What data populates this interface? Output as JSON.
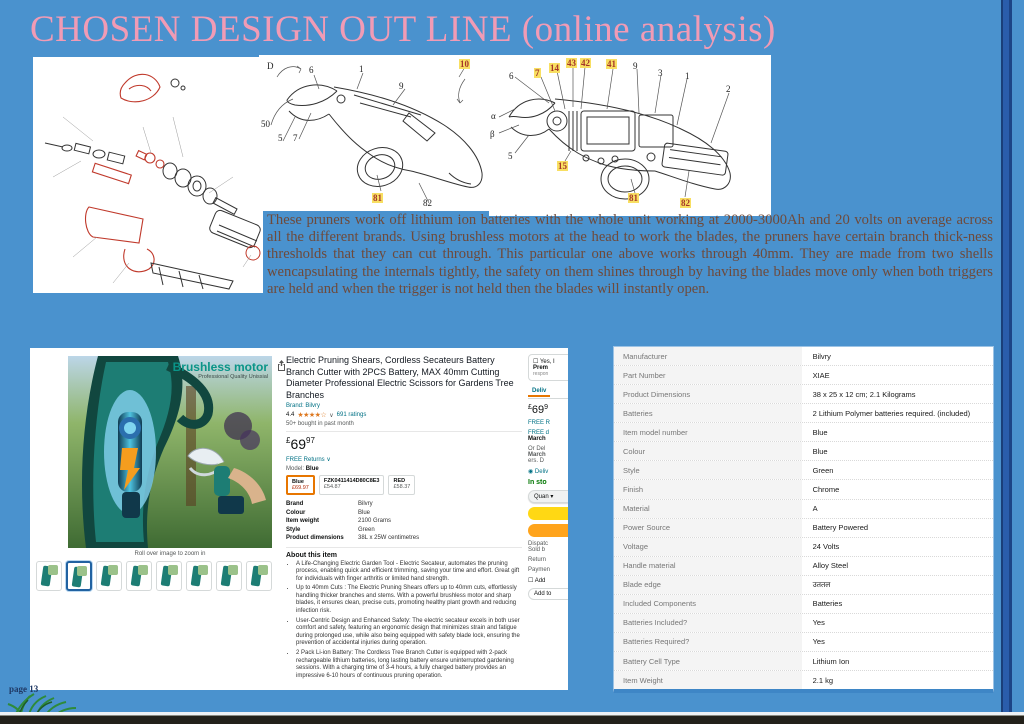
{
  "slide": {
    "title": "CHOSEN DESIGN OUT LINE (online analysis)",
    "page_label": "page 13",
    "paragraph": "These pruners work off lithium ion batteries with the whole unit working at 2000-3000Ah and 20 volts on average across all the different brands. Using brushless motors at the head to work the blades, the pruners have certain branch thick-ness thresholds that they can cut through. This particular one above works through 40mm. They are made from two shells wencapsulating the internals tightly, the safety on them shines through by having the blades move only when both triggers are held and when the trigger is not held then the blades will instantly open."
  },
  "diagrams": {
    "side_labels": [
      {
        "text": "D",
        "x": 8,
        "y": 6
      },
      {
        "text": "6",
        "x": 50,
        "y": 10
      },
      {
        "text": "1",
        "x": 100,
        "y": 9
      },
      {
        "text": "9",
        "x": 140,
        "y": 26
      },
      {
        "text": "10",
        "x": 200,
        "y": 4,
        "hl": true
      },
      {
        "text": "50",
        "x": 2,
        "y": 64,
        "amber": true
      },
      {
        "text": "5",
        "x": 19,
        "y": 78
      },
      {
        "text": "7",
        "x": 34,
        "y": 78
      },
      {
        "text": "81",
        "x": 113,
        "y": 138,
        "hl": true
      },
      {
        "text": "82",
        "x": 164,
        "y": 143
      }
    ],
    "cutaway_labels": [
      {
        "text": "6",
        "x": 20,
        "y": 16
      },
      {
        "text": "7",
        "x": 45,
        "y": 13,
        "hl": true
      },
      {
        "text": "14",
        "x": 60,
        "y": 8,
        "hl": true
      },
      {
        "text": "43",
        "x": 77,
        "y": 3,
        "hl": true
      },
      {
        "text": "42",
        "x": 91,
        "y": 3,
        "hl": true
      },
      {
        "text": "41",
        "x": 117,
        "y": 4,
        "hl": true
      },
      {
        "text": "9",
        "x": 144,
        "y": 6
      },
      {
        "text": "3",
        "x": 169,
        "y": 13
      },
      {
        "text": "1",
        "x": 196,
        "y": 16
      },
      {
        "text": "2",
        "x": 237,
        "y": 29
      },
      {
        "text": "α",
        "x": 2,
        "y": 56
      },
      {
        "text": "β",
        "x": 1,
        "y": 74
      },
      {
        "text": "5",
        "x": 19,
        "y": 96
      },
      {
        "text": "15",
        "x": 68,
        "y": 106,
        "hl": true
      },
      {
        "text": "81",
        "x": 139,
        "y": 138,
        "hl": true
      },
      {
        "text": "82",
        "x": 191,
        "y": 143,
        "hl": true
      }
    ]
  },
  "product_page": {
    "image_overlay_title": "Brushless motor",
    "image_overlay_subtitle": "Professional Quality Unissial",
    "image_caption": "Roll over image to zoom in",
    "thumbnails": [
      {
        "sel": false
      },
      {
        "sel": true
      },
      {
        "sel": false
      },
      {
        "sel": false
      },
      {
        "sel": false
      },
      {
        "sel": false
      },
      {
        "sel": false
      },
      {
        "sel": false
      }
    ],
    "title": "Electric Pruning Shears, Cordless Secateurs Battery Branch Cutter with 2PCS Battery, MAX 40mm Cutting Diameter Professional Electric Scissors for Gardens Tree Branches",
    "brand_line": "Brand: Bilvry",
    "rating_value": "4.4",
    "stars": "★★★★☆",
    "rating_caret": "∨",
    "ratings_count": "691 ratings",
    "bought_note": "50+ bought in past month",
    "price": {
      "symbol": "£",
      "whole": "69",
      "fraction": "97"
    },
    "free_returns": "FREE Returns ∨",
    "model_label": "Model:",
    "model_value": "Blue",
    "variants": [
      {
        "name": "Blue",
        "price": "£69.97",
        "sel": true
      },
      {
        "name": "FZK0411414D80C8E3",
        "price": "£54.87",
        "sel": false
      },
      {
        "name": "RED",
        "price": "£58.37",
        "sel": false
      }
    ],
    "mini_specs": [
      {
        "label": "Brand",
        "value": "Bilvry"
      },
      {
        "label": "Colour",
        "value": "Blue"
      },
      {
        "label": "Item weight",
        "value": "2100 Grams"
      },
      {
        "label": "Style",
        "value": "Green"
      },
      {
        "label": "Product dimensions",
        "value": "38L x 25W centimetres"
      }
    ],
    "about_title": "About this item",
    "about_bullets": [
      "A Life-Changing Electric Garden Tool - Electric Secateur, automates the pruning process, enabling quick and efficient trimming, saving your time and effort. Great gift for individuals with finger arthritis or limited hand strength.",
      "Up to 40mm Cuts : The Electric Pruning Shears offers up to 40mm cuts, effortlessly handling thicker branches and stems. With a powerful brushless motor and sharp blades, it ensures clean, precise cuts, promoting healthy plant growth and reducing infection risk.",
      "User-Centric Design and Enhanced Safety: The electric secateur excels in both user comfort and safety, featuring an ergonomic design that minimizes strain and fatigue during prolonged use, while also being equipped with safety blade lock, ensuring the prevention of accidental injuries during operation.",
      "2 Pack Li-ion Battery: The Cordless Tree Branch Cutter is equipped with 2-pack rechargeable lithium batteries, long lasting battery ensure uninterrupted gardening sessions. With a charging time of 3-4 hours, a fully charged battery provides an impressive 6-10 hours of continuous pruning operation."
    ],
    "buy_column": {
      "prime_check": "☐ Yes, I",
      "prime_bold": "Prem",
      "prime_small": "respon",
      "tab": "Deliv",
      "price_whole": "69",
      "price_symbol": "£",
      "price_fraction": "9",
      "free_returns": "FREE R",
      "free_delivery": "FREE d",
      "date1": "March",
      "or_fast": "Or Del",
      "date2": "March",
      "date2_tail": "ers. D",
      "deliver_to": "◉ Deliv",
      "stock": "In sto",
      "quantity": "Quan ▾",
      "dispatch": "Dispatc",
      "sold_by": "Sold b",
      "returns": "Return",
      "payment": "Paymen",
      "gift_check": "☐ Add",
      "wish": "Add to"
    }
  },
  "spec_table": {
    "rows": [
      {
        "label": "Manufacturer",
        "value": "Bilvry"
      },
      {
        "label": "Part Number",
        "value": "XIAE"
      },
      {
        "label": "Product Dimensions",
        "value": "38 x 25 x 12 cm; 2.1 Kilograms"
      },
      {
        "label": "Batteries",
        "value": "2 Lithium Polymer batteries required. (included)"
      },
      {
        "label": "Item model number",
        "value": "Blue"
      },
      {
        "label": "Colour",
        "value": "Blue"
      },
      {
        "label": "Style",
        "value": "Green"
      },
      {
        "label": "Finish",
        "value": "Chrome"
      },
      {
        "label": "Material",
        "value": "A"
      },
      {
        "label": "Power Source",
        "value": "Battery Powered"
      },
      {
        "label": "Voltage",
        "value": "24 Volts"
      },
      {
        "label": "Handle material",
        "value": "Alloy Steel"
      },
      {
        "label": "Blade edge",
        "value": "उततल"
      },
      {
        "label": "Included Components",
        "value": "Batteries"
      },
      {
        "label": "Batteries Included?",
        "value": "Yes"
      },
      {
        "label": "Batteries Required?",
        "value": "Yes"
      },
      {
        "label": "Battery Cell Type",
        "value": "Lithium Ion"
      },
      {
        "label": "Item Weight",
        "value": "2.1 kg"
      }
    ]
  }
}
